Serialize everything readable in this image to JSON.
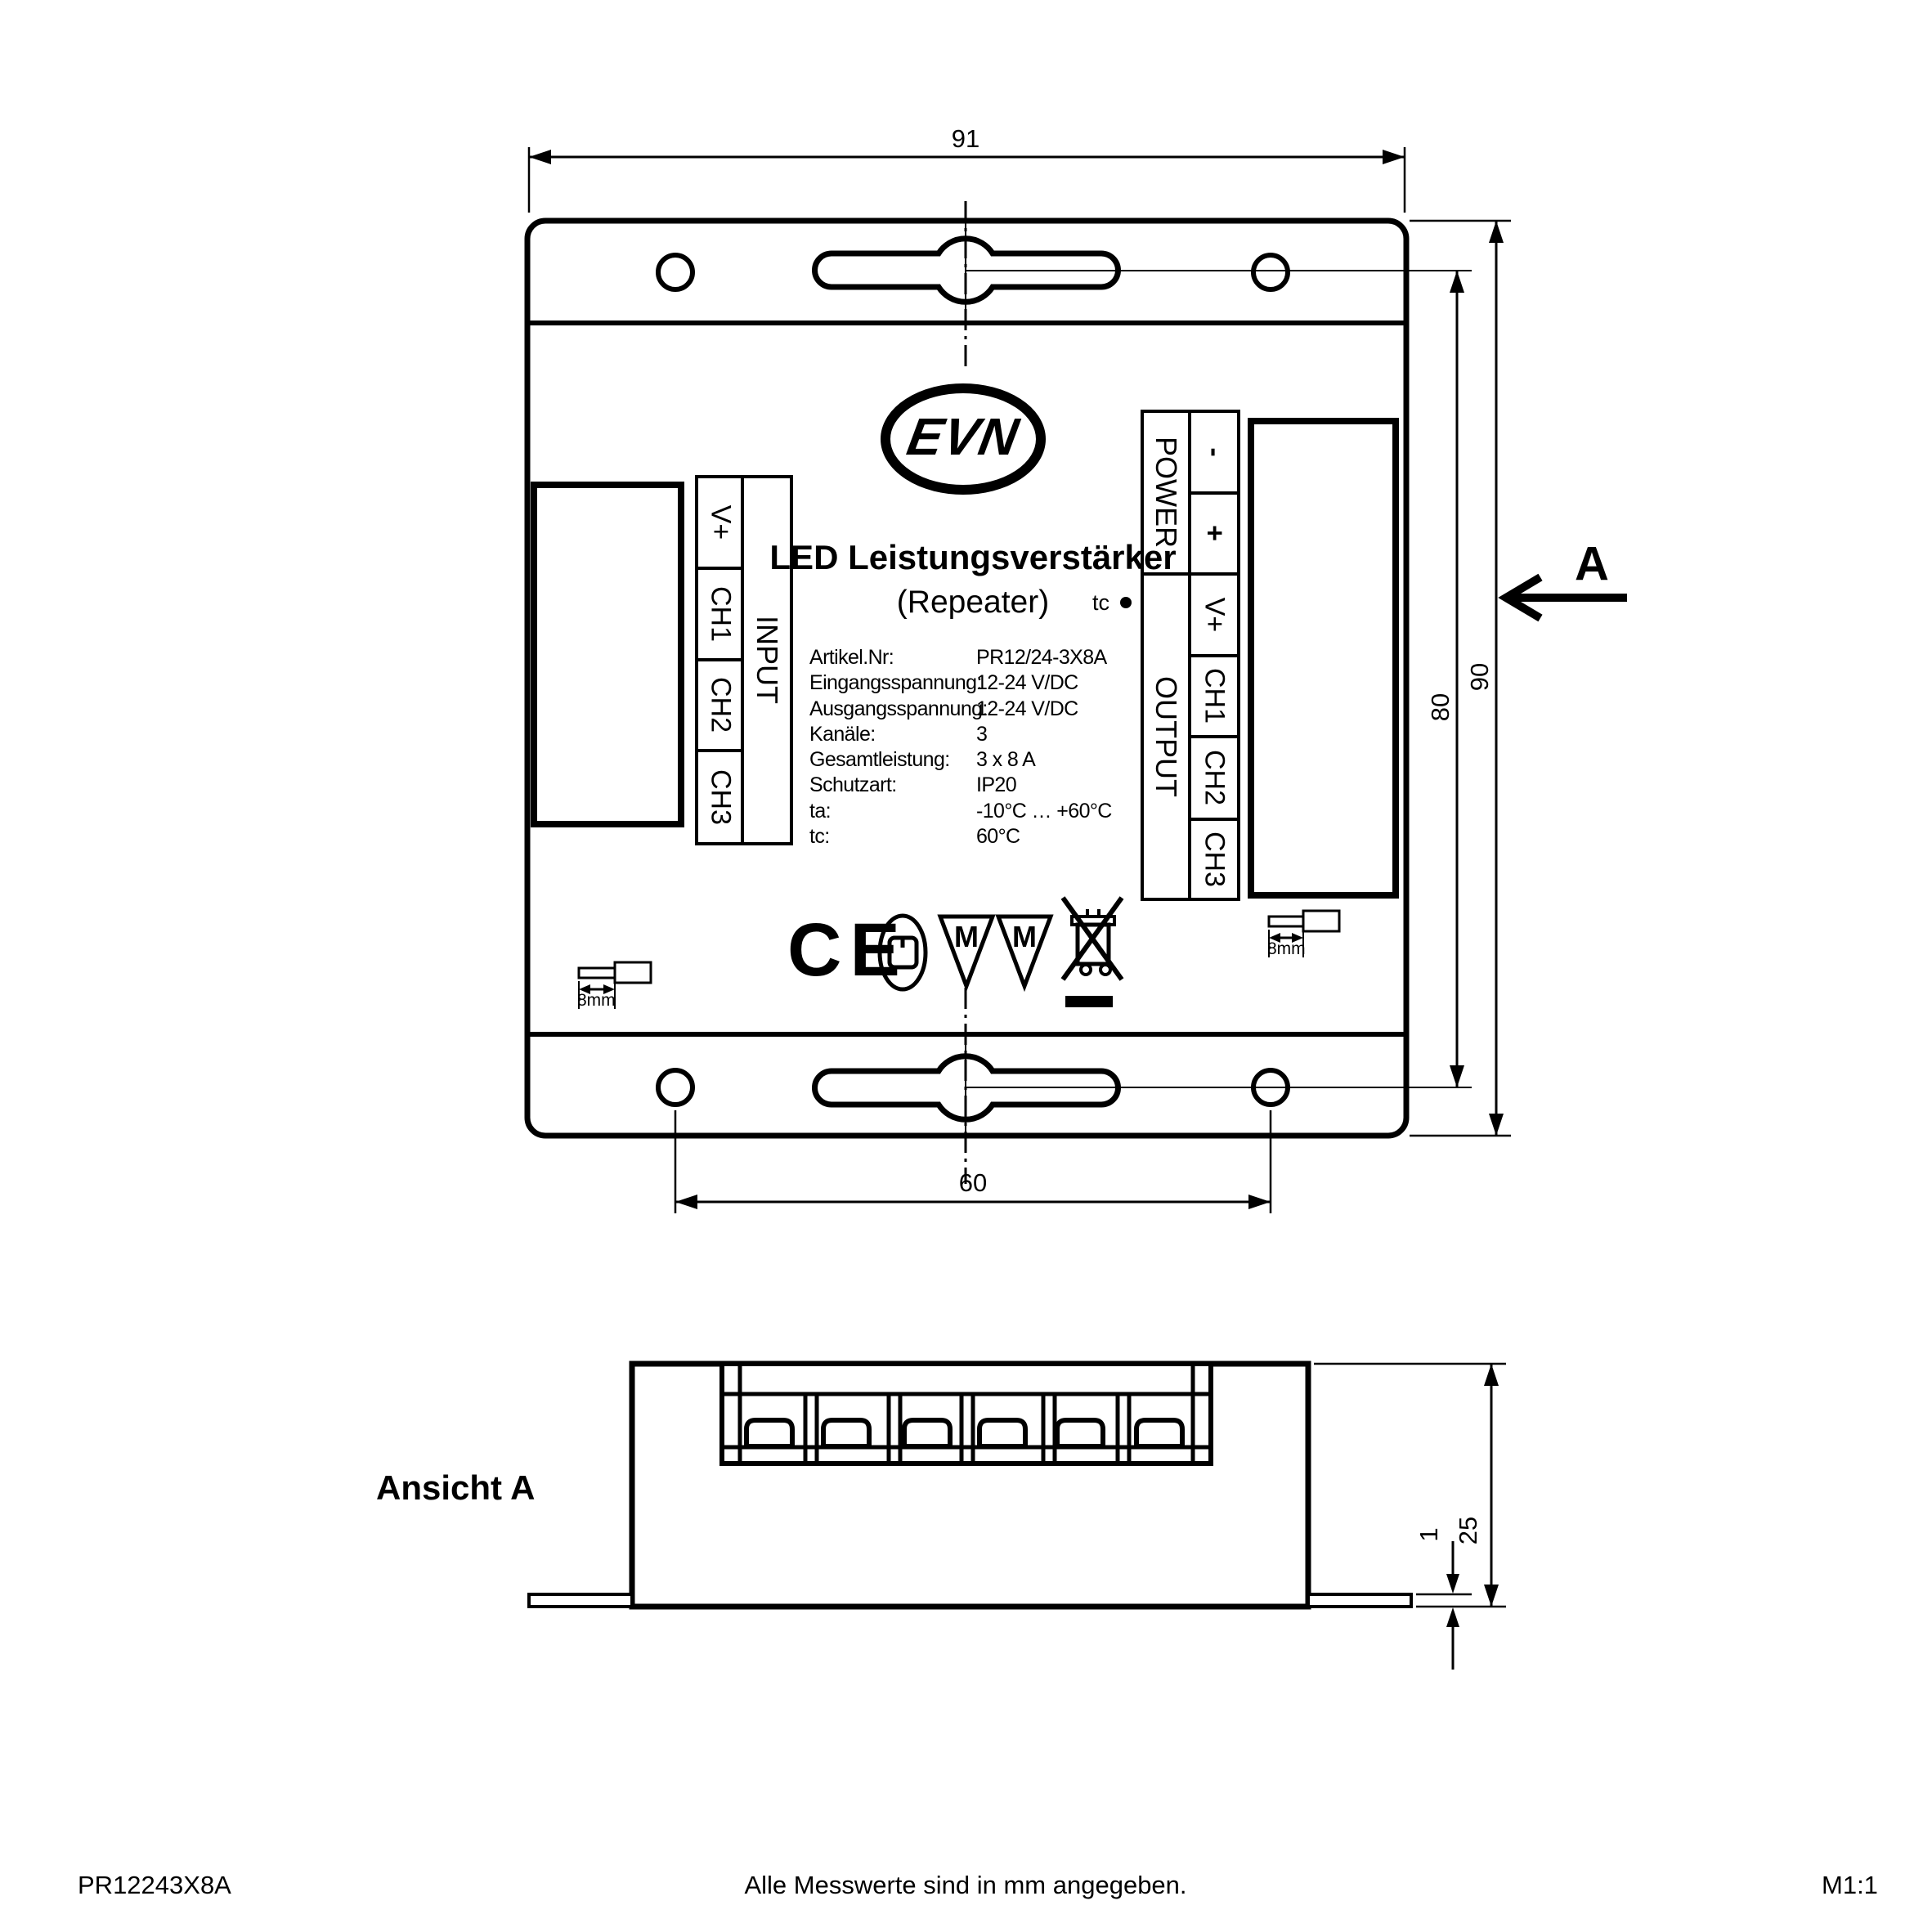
{
  "top_view": {
    "dim_width": "91",
    "dim_height": "90",
    "dim_hole_height": "80",
    "dim_hole_spacing": "60",
    "logo": "EVN",
    "title": "LED Leistungsverstärker",
    "subtitle": "(Repeater)",
    "tc_label": "tc",
    "input_block": {
      "header": "INPUT",
      "terminals": [
        "V+",
        "CH1",
        "CH2",
        "CH3"
      ]
    },
    "output_block": {
      "power_header": "POWER",
      "output_header": "OUTPUT",
      "power_terminals": [
        "-",
        "+"
      ],
      "output_terminals": [
        "V+",
        "CH1",
        "CH2",
        "CH3"
      ]
    },
    "specs": [
      {
        "label": "Artikel.Nr:",
        "value": "PR12/24-3X8A"
      },
      {
        "label": "Eingangsspannung:",
        "value": "12-24 V/DC"
      },
      {
        "label": "Ausgangsspannung:",
        "value": "12-24 V/DC"
      },
      {
        "label": "Kanäle:",
        "value": "3"
      },
      {
        "label": "Gesamtleistung:",
        "value": "3 x 8 A"
      },
      {
        "label": "Schutzart:",
        "value": "IP20"
      },
      {
        "label": "ta:",
        "value": "-10°C … +60°C"
      },
      {
        "label": "tc:",
        "value": "60°C"
      }
    ],
    "marks": {
      "ce": "CE",
      "m": "M"
    },
    "strip_left": "8mm",
    "strip_right": "8mm"
  },
  "side_view": {
    "label": "Ansicht A",
    "dim_height": "25",
    "dim_flange": "1"
  },
  "view_arrow": {
    "label": "A"
  },
  "footer": {
    "article": "PR12243X8A",
    "note": "Alle Messwerte sind in mm angegeben.",
    "scale": "M1:1"
  }
}
